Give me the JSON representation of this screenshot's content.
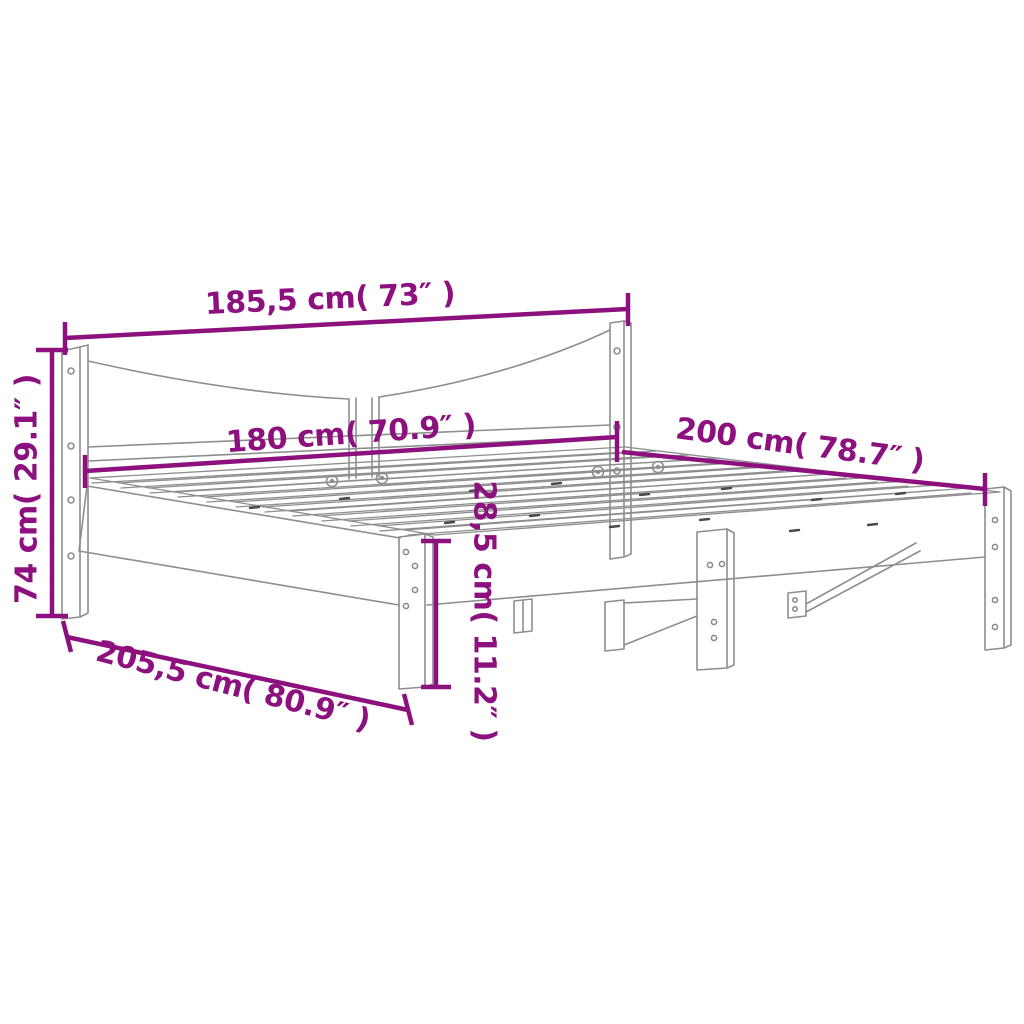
{
  "diagram": {
    "subject": "bed-frame-dimension-drawing",
    "accent_color": "#8C117E",
    "drawing_line_color": "#8E8E8E",
    "background_color": "#FFFFFF",
    "dimensions": {
      "headboard_width": {
        "label": "185,5 cm( 73″ )",
        "value_cm": "185,5",
        "value_inch": "73"
      },
      "inner_width": {
        "label": "180 cm( 70.9″ )",
        "value_cm": "180",
        "value_inch": "70.9"
      },
      "length": {
        "label": "200 cm( 78.7″ )",
        "value_cm": "200",
        "value_inch": "78.7"
      },
      "total_length": {
        "label": "205,5 cm( 80.9″ )",
        "value_cm": "205,5",
        "value_inch": "80.9"
      },
      "total_height": {
        "label": "74 cm( 29.1″ )",
        "value_cm": "74",
        "value_inch": "29.1"
      },
      "frame_height": {
        "label": "28,5 cm( 11.2″ )",
        "value_cm": "28,5",
        "value_inch": "11.2"
      }
    }
  }
}
